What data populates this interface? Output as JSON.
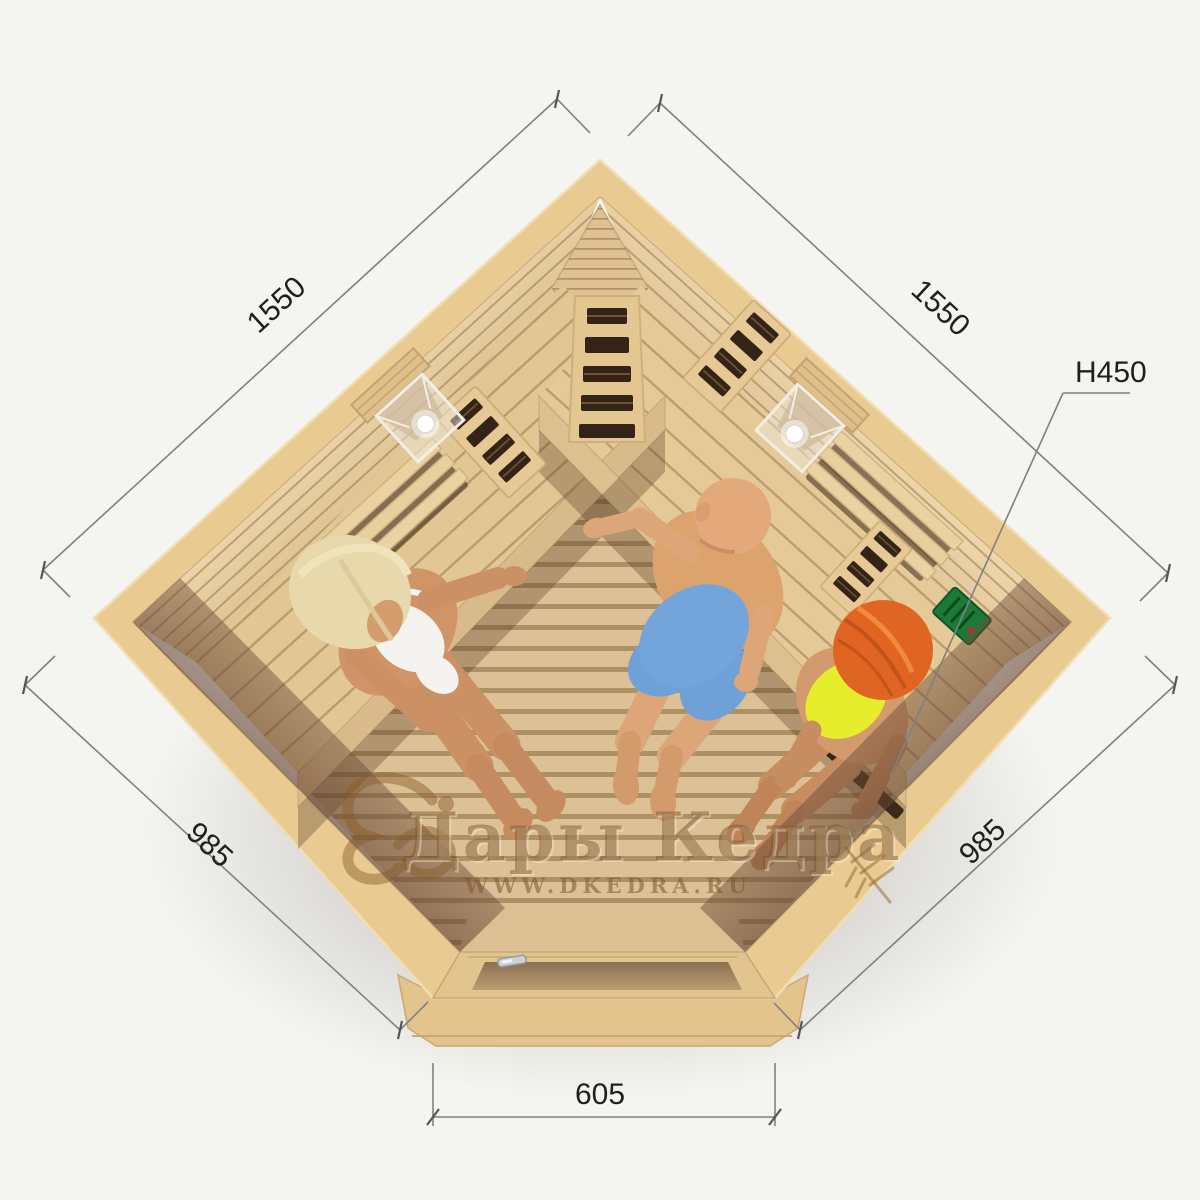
{
  "scene": {
    "description": "Top view 3D render of a corner infrared sauna cabin with three people seated inside, annotated with outside dimensions",
    "colors": {
      "background": "#f4f4f1",
      "wood_rim": "#e9cb92",
      "wood_wall": "#e3c79b",
      "wood_bench": "#e2c694",
      "wood_floor": "#d9bd92",
      "floor_gap": "#a5875c",
      "glass_tint": "#7d5b44",
      "heater_slot": "#342417",
      "control_panel_green": "#1c7a38",
      "shorts_blue": "#6fa0d6",
      "swimsuit_yellow": "#e6ee2b",
      "bikini_white": "#f4f3ef",
      "hair_blonde": "#e7d9ac",
      "hair_red": "#e06522",
      "dimension_line": "#808080",
      "dimension_text": "#1f1f1f",
      "watermark_brown": "#8a5d28"
    },
    "people": [
      {
        "id": "woman-blonde",
        "label": "blonde woman in white bikini on left bench"
      },
      {
        "id": "man-bald",
        "label": "bald man in blue shorts on corner bench"
      },
      {
        "id": "woman-redhead",
        "label": "red-haired woman in yellow swimsuit on right bench"
      }
    ],
    "fixtures": [
      {
        "id": "corner-heater-grille"
      },
      {
        "id": "left-wall-heater-grille"
      },
      {
        "id": "right-wall-heater-grille"
      },
      {
        "id": "right-wall-lower-heater-grille"
      },
      {
        "id": "left-wall-lamp"
      },
      {
        "id": "right-wall-lamp"
      },
      {
        "id": "control-panel"
      },
      {
        "id": "glass-door-with-handle"
      }
    ]
  },
  "dimensions": {
    "back_left_wall": "1550",
    "back_right_wall": "1550",
    "front_left_wall": "985",
    "front_right_wall": "985",
    "door_front": "605",
    "height_callout": "H450"
  },
  "watermark": {
    "title": "Дары Кедра",
    "website": "WWW.DKEDRA.RU"
  }
}
